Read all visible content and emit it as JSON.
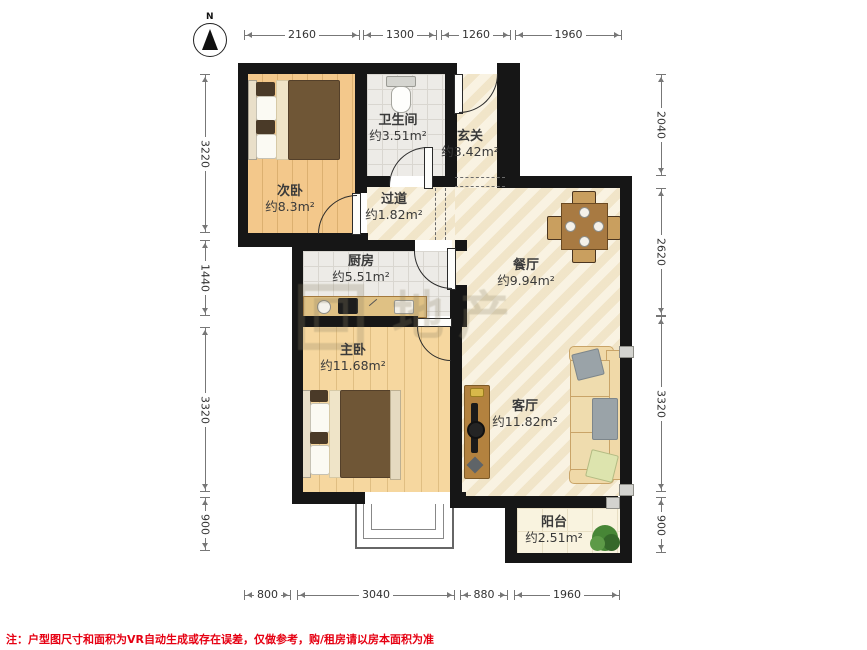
{
  "compass": {
    "label": "N"
  },
  "dims": {
    "top": [
      "2160",
      "1300",
      "1260",
      "1960"
    ],
    "bottom": [
      "800",
      "3040",
      "880",
      "1960"
    ],
    "left": [
      "3220",
      "1440",
      "3320",
      "900"
    ],
    "right": [
      "2040",
      "2620",
      "3320",
      "900"
    ]
  },
  "rooms": [
    {
      "name": "次卧",
      "area": "约8.3m²"
    },
    {
      "name": "卫生间",
      "area": "约3.51m²"
    },
    {
      "name": "玄关",
      "area": "约3.42m²"
    },
    {
      "name": "过道",
      "area": "约1.82m²"
    },
    {
      "name": "厨房",
      "area": "约5.51m²"
    },
    {
      "name": "餐厅",
      "area": "约9.94m²"
    },
    {
      "name": "主卧",
      "area": "约11.68m²"
    },
    {
      "name": "客厅",
      "area": "约11.82m²"
    },
    {
      "name": "阳台",
      "area": "约2.51m²"
    }
  ],
  "watermark": {
    "text": "地产"
  },
  "note": {
    "text": "注：户型图尺寸和面积为VR自动生成或存在误差，仅做参考，购/租房请以房本面积为准"
  },
  "colors": {
    "wall": "#161616",
    "bedroom_floor": "#f3c88b",
    "master_floor": "#f6d79f",
    "tile_floor": "#edebe7",
    "marble_floor": "#f6ecd3",
    "balcony_floor": "#f9f3df",
    "note_red": "#e60012"
  }
}
